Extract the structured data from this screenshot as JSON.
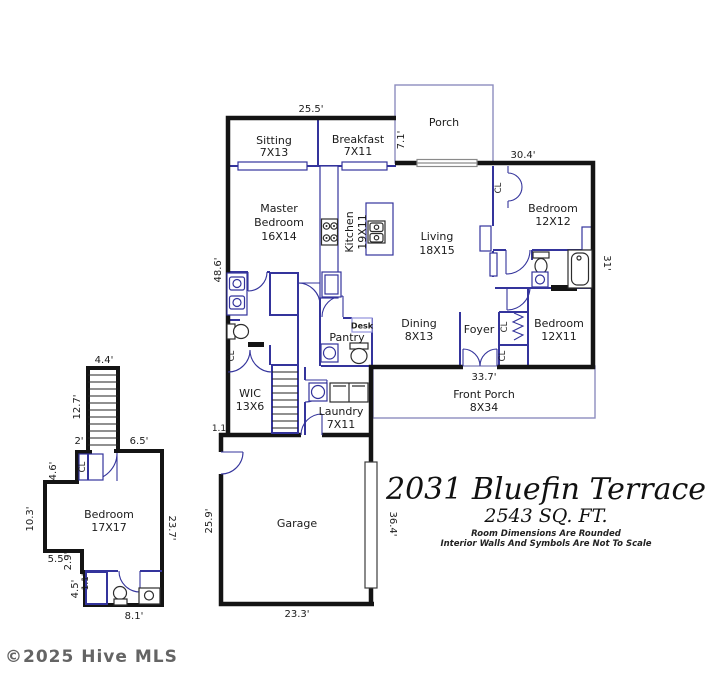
{
  "title_block": {
    "address": "2031 Bluefin Terrace",
    "area": "2543 SQ. FT.",
    "disclaimer1": "Room Dimensions Are Rounded",
    "disclaimer2": "Interior Walls And Symbols Are Not To Scale"
  },
  "copyright": "©2025 Hive MLS",
  "colors": {
    "exterior_wall": "#141414",
    "interior_wall": "#34349c",
    "porch_outline": "#8d8dbf",
    "window": "#8a8a8a",
    "text": "#1b1b1b"
  },
  "fp": {
    "closet_label": "CL",
    "rooms": {
      "sitting": [
        "Sitting",
        "7X13"
      ],
      "breakfast": [
        "Breakfast",
        "7X11"
      ],
      "porch": [
        "Porch"
      ],
      "master": [
        "Master",
        "Bedroom",
        "16X14"
      ],
      "kitchen": [
        "Kitchen",
        "19X11"
      ],
      "living": [
        "Living",
        "18X15"
      ],
      "bedroom1": [
        "Bedroom",
        "12X12"
      ],
      "bedroom2": [
        "Bedroom",
        "12X11"
      ],
      "dining": [
        "Dining",
        "8X13"
      ],
      "foyer": [
        "Foyer"
      ],
      "pantry": [
        "Pantry"
      ],
      "desk": [
        "Desk"
      ],
      "wic": [
        "WIC",
        "13X6"
      ],
      "laundry": [
        "Laundry",
        "7X11"
      ],
      "front_porch": [
        "Front Porch",
        "8X34"
      ],
      "garage": [
        "Garage"
      ],
      "bedroom3": [
        "Bedroom",
        "17X17"
      ]
    },
    "dims": {
      "d255": "25.5'",
      "d71": "7.1'",
      "d304": "30.4'",
      "d31": "31'",
      "d486": "48.6'",
      "d337": "33.7'",
      "d11a": "1.1",
      "d259": "25.9'",
      "d364": "36.4'",
      "d233": "23.3'",
      "d44": "4.4'",
      "d127": "12.7'",
      "d2": "2'",
      "d65": "6.5'",
      "d46": "4.6'",
      "d103": "10.3'",
      "d55": "5.5'",
      "d29": "2.9'",
      "d45": "4.5'",
      "d11b": "1.1'",
      "d81": "8.1'",
      "d237": "23.7'"
    }
  }
}
